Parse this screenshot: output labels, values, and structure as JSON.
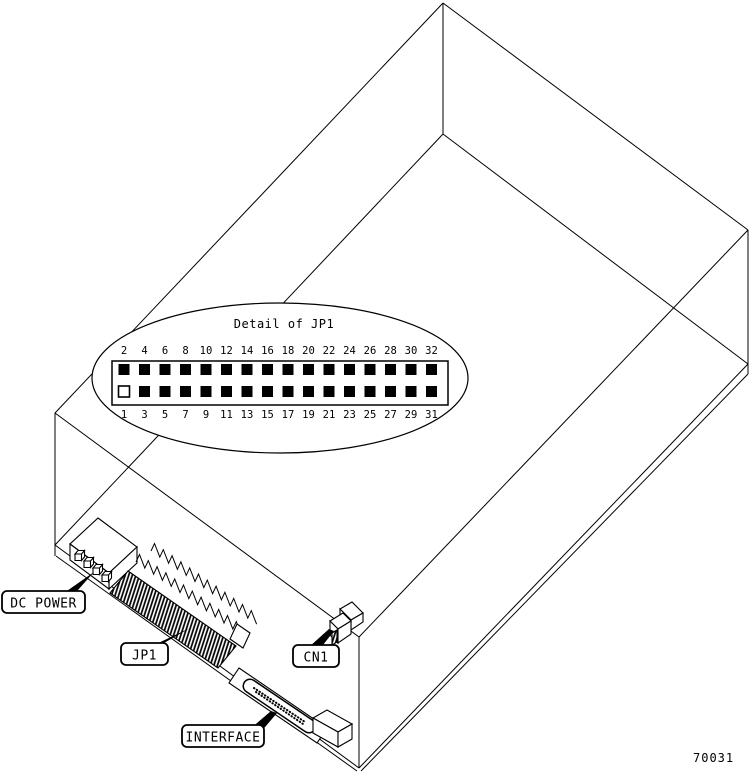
{
  "figure_number": "70031",
  "detail_callout": {
    "title": "Detail of JP1",
    "top_pin_numbers": [
      "2",
      "4",
      "6",
      "8",
      "10",
      "12",
      "14",
      "16",
      "18",
      "20",
      "22",
      "24",
      "26",
      "28",
      "30",
      "32"
    ],
    "bottom_pin_numbers": [
      "1",
      "3",
      "5",
      "7",
      "9",
      "11",
      "13",
      "15",
      "17",
      "19",
      "21",
      "23",
      "25",
      "27",
      "29",
      "31"
    ],
    "unfilled_pins": [
      "1"
    ]
  },
  "component_labels": {
    "dc_power": "DC POWER",
    "jp1": "JP1",
    "cn1": "CN1",
    "interface": "INTERFACE"
  },
  "colors": {
    "ink": "#000000",
    "paper": "#ffffff"
  }
}
